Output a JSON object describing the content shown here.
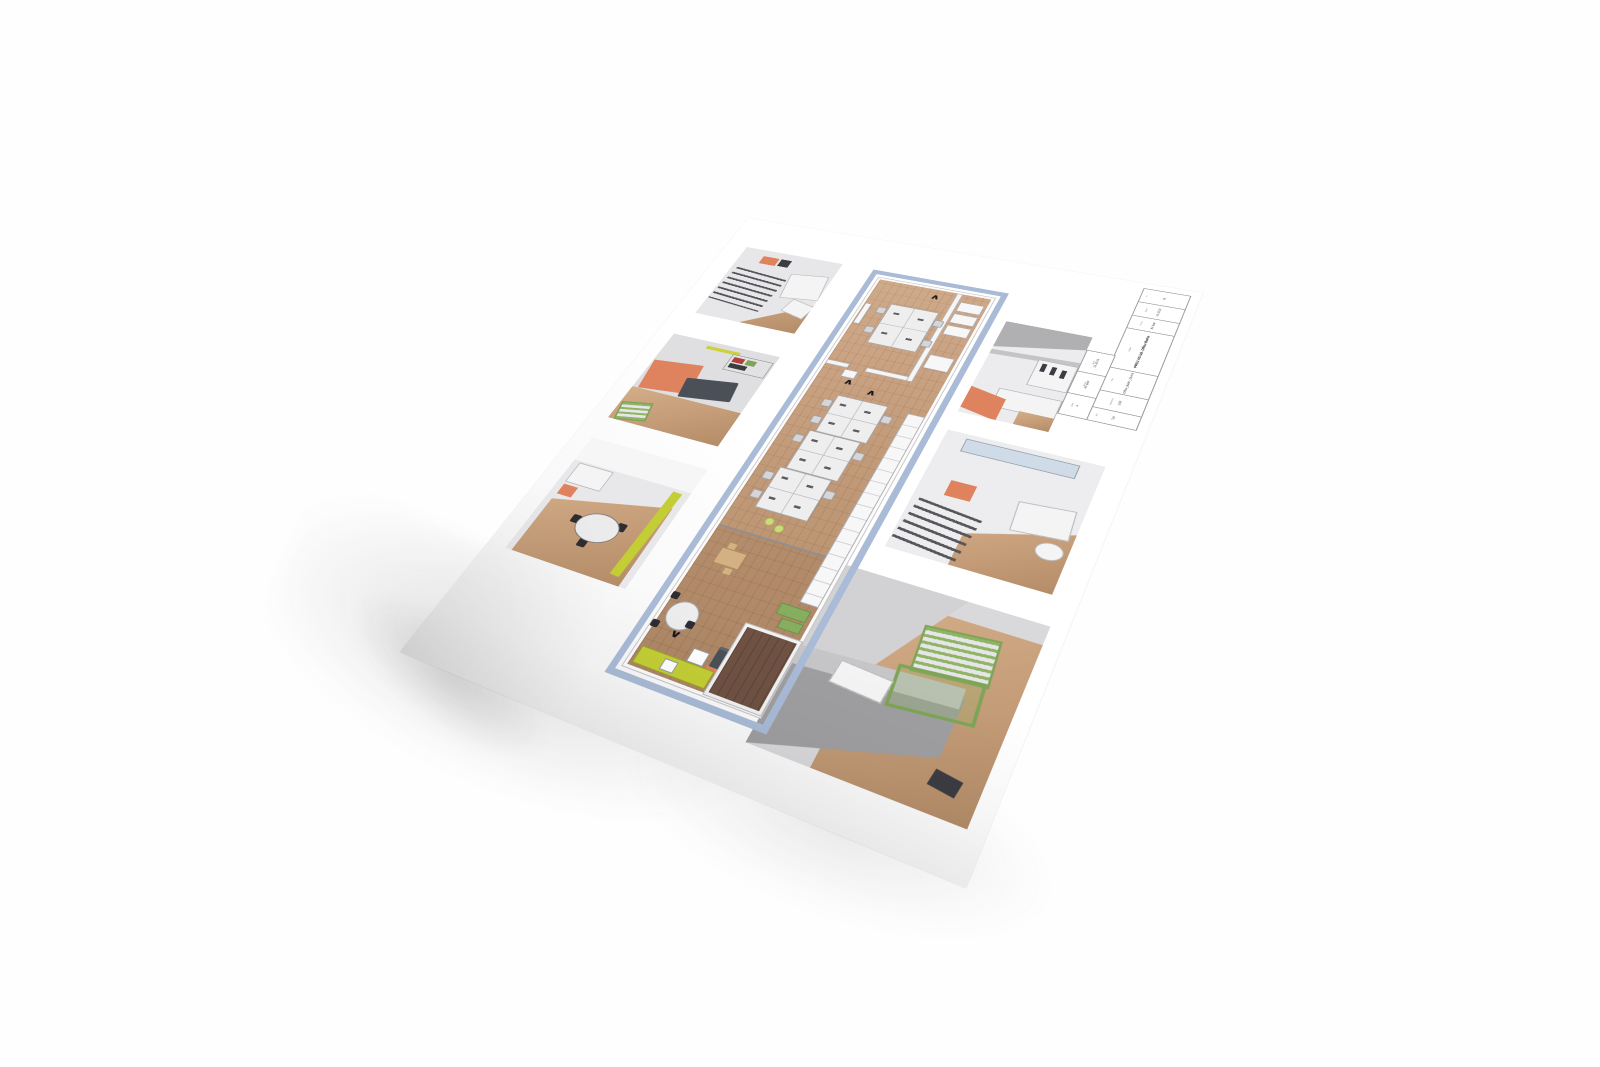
{
  "colors": {
    "plan_border_blue": "#a9bbd7",
    "accent_lime": "#c3ce35",
    "accent_orange": "#df835e",
    "accent_green": "#86ae5e",
    "wood_floor": "#c29d7b",
    "sofa_dark": "#4b4f58",
    "paper_white": "#ffffff",
    "shadow_gray": "#d9d9db"
  },
  "title_block": {
    "col_a": [
      {
        "label": "Nr.",
        "value": "03"
      },
      {
        "label": "Datum",
        "value": "21.12.21"
      },
      {
        "label": "Format",
        "value": "A2 quer"
      },
      {
        "label": "Projekt",
        "value": "PROJ AG lab. Office Berlin"
      },
      {
        "label": "Plan",
        "value": "Office_Berlin_23.mm"
      },
      {
        "label": "Massstab",
        "value": "1:50"
      },
      {
        "label": "gez.",
        "value": "TM"
      }
    ],
    "col_b": [
      {
        "label": "Datum",
        "value": "21.12.21"
      },
      {
        "label": "Format",
        "value": "A2 quer"
      },
      {
        "label": "Index",
        "value": "a"
      }
    ]
  },
  "plan": {
    "markers": [
      {
        "glyph": "∧"
      },
      {
        "glyph": "∧"
      },
      {
        "glyph": "∧"
      },
      {
        "glyph": "∨"
      },
      {
        "glyph": "∨"
      }
    ]
  }
}
